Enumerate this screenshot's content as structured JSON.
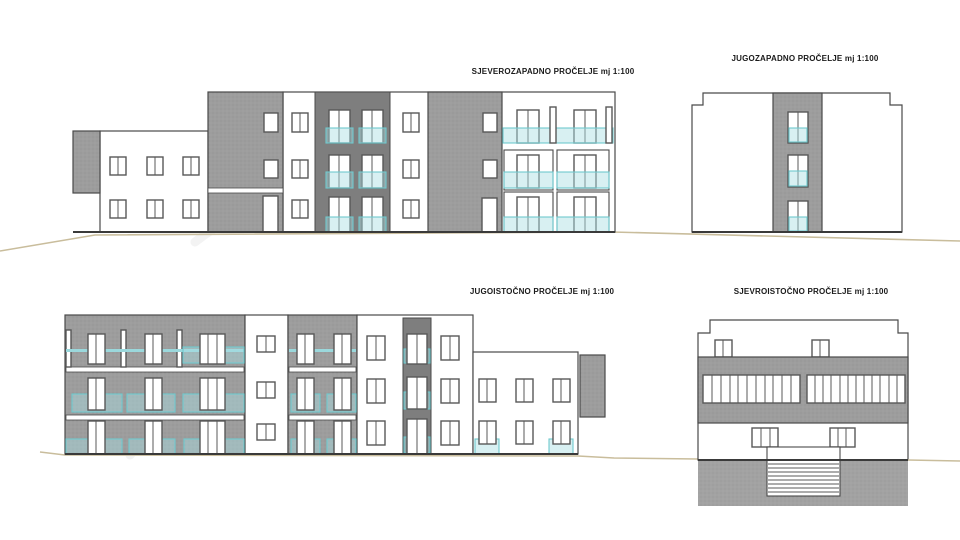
{
  "sheet": {
    "type": "architectural-elevation-drawing",
    "scale_note": "mj 1:100",
    "background": "#ffffff"
  },
  "elevations": [
    {
      "id": "northwest",
      "title": "SJEVEROZAPADNO PROČELJE mj 1:100"
    },
    {
      "id": "southwest",
      "title": "JUGOZAPADNO PROČELJE mj 1:100"
    },
    {
      "id": "southeast",
      "title": "JUGOISTOČNO PROČELJE mj 1:100"
    },
    {
      "id": "northeast",
      "title": "SJEVROISTOČNO PROČELJE mj 1:100"
    }
  ],
  "colors": {
    "facade_hatch_gray": "#9d9d9d",
    "recess_dark_gray": "#7e7e7e",
    "window_frame": "#585858",
    "railing_teal": "#6fc9ce",
    "railing_teal_fill": "rgba(168,222,226,0.45)",
    "terrain_tan": "#c9bd9c",
    "outline": "#4a4a4a"
  }
}
